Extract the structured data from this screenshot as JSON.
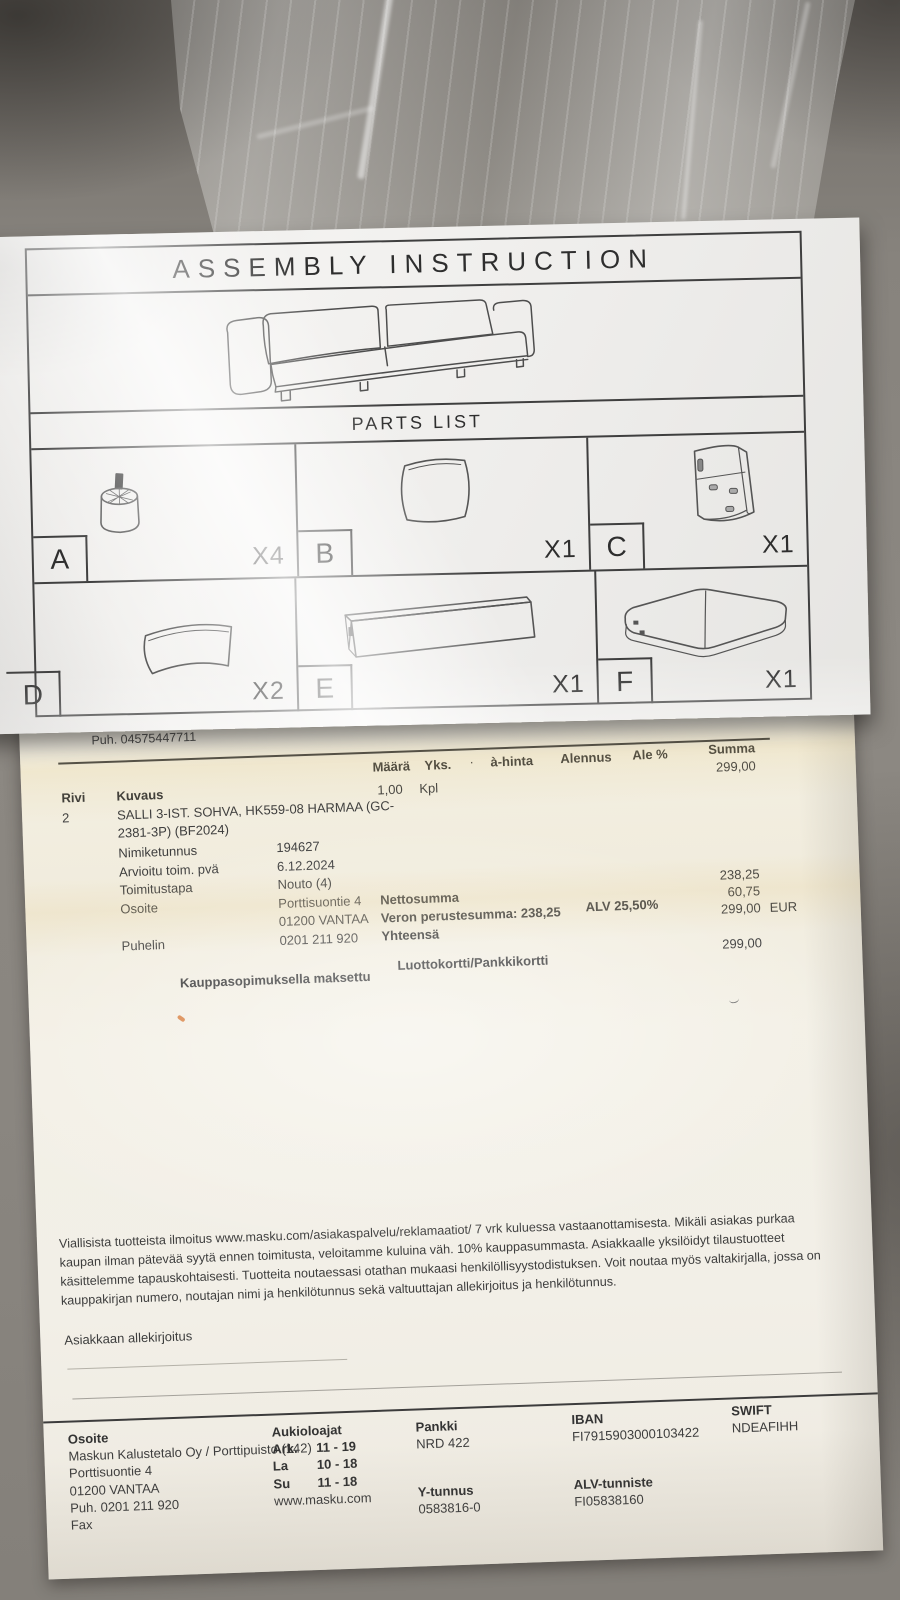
{
  "colors": {
    "couch_fabric": "#827e78",
    "sheet_paper": "#efeeec",
    "receipt_paper": "#f2efe4",
    "ink": "#3d3d3d",
    "highlight_band": "#e4ca84",
    "speck_orange": "#d2691e"
  },
  "assembly_sheet": {
    "title": "ASSEMBLY INSTRUCTION",
    "parts_list_title": "PARTS LIST",
    "parts": [
      {
        "label": "A",
        "count": "X4"
      },
      {
        "label": "B",
        "count": "X1"
      },
      {
        "label": "C",
        "count": "X1"
      },
      {
        "label": "D",
        "count": "X2"
      },
      {
        "label": "E",
        "count": "X1"
      },
      {
        "label": "F",
        "count": "X1"
      }
    ]
  },
  "receipt": {
    "phone_top": "Puh. 04575447711",
    "table_header": {
      "maara": "Määrä",
      "yks": "Yks.",
      "dot": "·",
      "a_hinta": "à-hinta",
      "alennus": "Alennus",
      "ale_pct": "Ale %",
      "summa": "Summa",
      "summa_value": "299,00",
      "qty": "1,00",
      "unit": "Kpl"
    },
    "line_item": {
      "rivi_label": "Rivi",
      "rivi_value": "2",
      "kuvaus_label": "Kuvaus",
      "description_line1": "SALLI 3-IST. SOHVA, HK559-08 HARMAA (GC-",
      "description_line2": "2381-3P) (BF2024)",
      "fields": [
        {
          "label": "Nimiketunnus",
          "value": "194627"
        },
        {
          "label": "Arvioitu toim. pvä",
          "value": "6.12.2024"
        },
        {
          "label": "Toimitustapa",
          "value": "Nouto (4)"
        },
        {
          "label": "Osoite",
          "value": "Porttisuontie 4"
        },
        {
          "label": "",
          "value": "01200 VANTAA"
        },
        {
          "label": "Puhelin",
          "value": "0201 211 920"
        }
      ]
    },
    "totals": {
      "nettosumma_label": "Nettosumma",
      "veron_label": "Veron perustesumma: 238,25",
      "alv_label": "ALV 25,50%",
      "yhteensa_label": "Yhteensä",
      "nettosumma_value": "238,25",
      "alv_value": "60,75",
      "yhteensa_value": "299,00",
      "currency": "EUR"
    },
    "payment": {
      "left_label": "Kauppasopimuksella maksettu",
      "method": "Luottokortti/Pankkikortti",
      "amount": "299,00"
    },
    "terms_lines": [
      "Viallisista tuotteista ilmoitus www.masku.com/asiakaspalvelu/reklamaatiot/ 7 vrk kuluessa vastaanottamisesta. Mikäli asiakas purkaa",
      "kaupan ilman pätevää syytä ennen toimitusta, veloitamme kuluina väh. 10% kauppasummasta. Asiakkaalle yksilöidyt tilaustuotteet",
      "käsittelemme tapauskohtaisesti. Tuotteita noutaessasi otathan mukaasi henkilöllisyystodistuksen. Voit noutaa myös valtakirjalla, jossa on",
      "kauppakirjan numero, noutajan nimi ja henkilötunnus sekä valtuuttajan allekirjoitus ja henkilötunnus."
    ],
    "signature_label": "Asiakkaan allekirjoitus",
    "footer": {
      "osoite_label": "Osoite",
      "company": "Maskun Kalustetalo Oy / Porttipuisto (142)",
      "street": "Porttisuontie 4",
      "city": "01200 VANTAA",
      "phone": "Puh.  0201 211 920",
      "fax_label": "Fax",
      "hours_label": "Aukioloajat",
      "hours": [
        {
          "day": "Ark.",
          "time": "11 - 19"
        },
        {
          "day": "La",
          "time": "10 - 18"
        },
        {
          "day": "Su",
          "time": "11 - 18"
        }
      ],
      "website": "www.masku.com",
      "bank_label": "Pankki",
      "bank_value": "NRD 422",
      "business_id_label": "Y-tunnus",
      "business_id_value": "0583816-0",
      "iban_label": "IBAN",
      "iban_value": "FI7915903000103422",
      "vat_label": "ALV-tunniste",
      "vat_value": "FI05838160",
      "swift_label": "SWIFT",
      "swift_value": "NDEAFIHH"
    }
  }
}
